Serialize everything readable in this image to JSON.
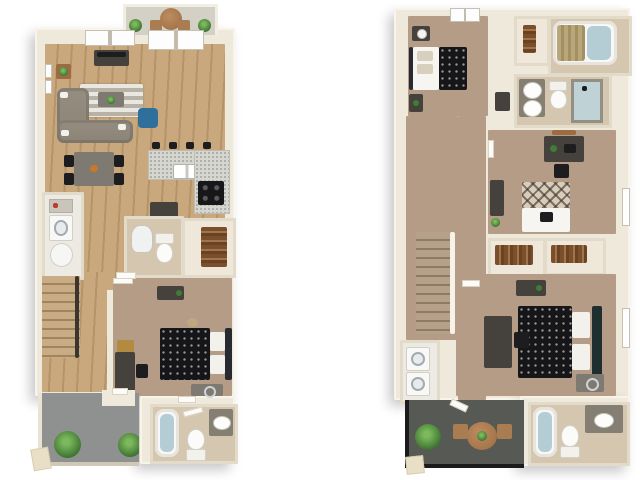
{
  "image": {
    "type": "3d-floorplan-rendering",
    "background": "#ffffff"
  },
  "labels": {
    "mech_closet": "Mech."
  },
  "colors": {
    "bg": "#ffffff",
    "wall": "#efe9dc",
    "wall_edge": "#f8f4ea",
    "wall_line": "#e3dbc9",
    "wood": "#c8a87c",
    "wood_dark": "#b6946a",
    "carpet": "#b59c87",
    "tile": "#d5c6b0",
    "closet_floor": "#efe8da",
    "laundry_floor": "#eceae2",
    "patio": "#8f9090",
    "deck": "#575954",
    "balcony": "#d3d0c5",
    "sofa": "#8b8376",
    "accent_blue": "#2f6f9c",
    "furniture_dark": "#45413c",
    "bed_black": "#161618",
    "granite": "#d6d6d1",
    "plant_green": "#39702f",
    "table_wood": "#9c6b43",
    "railing": "#1b1b1b",
    "gold": "#b28b41"
  },
  "floorplans": [
    {
      "name": "first-floor",
      "position": "left",
      "rooms": [
        {
          "name": "balcony",
          "furniture": [
            "round-table",
            "two-chairs",
            "plants"
          ]
        },
        {
          "name": "living-room",
          "furniture": [
            "sectional-sofa",
            "accent-chair",
            "coffee-table",
            "rug",
            "tv-console",
            "tv",
            "side-table",
            "wall-art"
          ]
        },
        {
          "name": "dining-area",
          "furniture": [
            "dining-table",
            "four-chairs"
          ]
        },
        {
          "name": "kitchen",
          "furniture": [
            "l-shaped-counter",
            "double-sink",
            "stove",
            "bar-stools",
            "island"
          ]
        },
        {
          "name": "laundry-closet",
          "furniture": [
            "shelf",
            "washer",
            "water-heater"
          ]
        },
        {
          "name": "half-bath",
          "furniture": [
            "pedestal-sink",
            "toilet"
          ]
        },
        {
          "name": "hall-closet",
          "furniture": [
            "hanging-clothes"
          ]
        },
        {
          "name": "stairs",
          "furniture": [
            "railing"
          ]
        },
        {
          "name": "bedroom-1",
          "furniture": [
            "bed",
            "dresser",
            "desk",
            "desk-chair",
            "bench",
            "nightstand"
          ]
        },
        {
          "name": "bathroom-1",
          "furniture": [
            "bathtub",
            "toilet",
            "vanity-sink",
            "towel-bar"
          ]
        },
        {
          "name": "patio",
          "furniture": [
            "plants",
            "entry-step"
          ]
        }
      ]
    },
    {
      "name": "second-floor",
      "position": "right",
      "rooms": [
        {
          "name": "bedroom-2",
          "furniture": [
            "bed",
            "nightstand",
            "lamp",
            "dresser",
            "window"
          ]
        },
        {
          "name": "linen-closet",
          "furniture": [
            "towels"
          ]
        },
        {
          "name": "bathroom-2",
          "furniture": [
            "bathtub",
            "shower-curtain"
          ]
        },
        {
          "name": "bathroom-3",
          "furniture": [
            "double-vanity",
            "toilet",
            "shower"
          ]
        },
        {
          "name": "mech-closet",
          "label": "Mech.",
          "furniture": [
            "mechanical-unit",
            "shelf"
          ]
        },
        {
          "name": "hallway",
          "furniture": [
            "small-desk",
            "small-closet"
          ]
        },
        {
          "name": "stairs",
          "furniture": [
            "railing"
          ]
        },
        {
          "name": "bedroom-3",
          "furniture": [
            "bed",
            "desk",
            "desk-chair",
            "dresser",
            "plant",
            "wall-shelf"
          ]
        },
        {
          "name": "walk-in-closets",
          "furniture": [
            "hanging-clothes"
          ]
        },
        {
          "name": "bedroom-4",
          "furniture": [
            "bed",
            "dresser",
            "desk",
            "desk-chair",
            "nightstand"
          ]
        },
        {
          "name": "laundry-closet",
          "furniture": [
            "stacked-washer-dryer"
          ]
        },
        {
          "name": "bathroom-4",
          "furniture": [
            "bathtub",
            "toilet",
            "vanity-sink"
          ]
        },
        {
          "name": "balcony",
          "furniture": [
            "round-table",
            "two-chairs",
            "plant",
            "railing",
            "entry-step"
          ]
        }
      ]
    }
  ]
}
